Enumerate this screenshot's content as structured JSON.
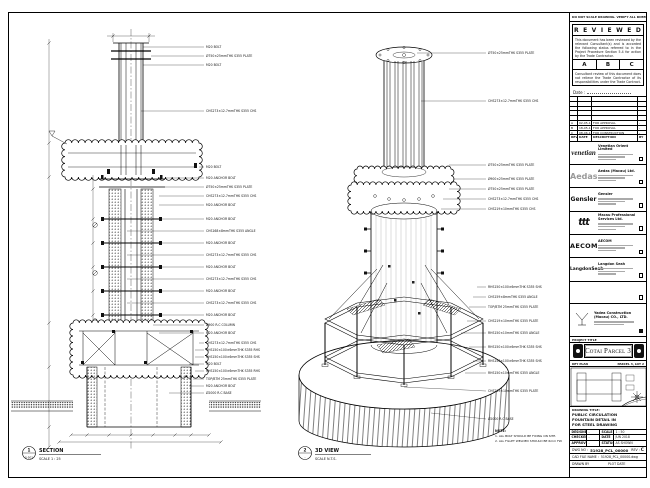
{
  "sheet": {
    "top_note": "DO NOT SCALE DRAWING. VERIFY ALL DIMENSIONS ON SITE."
  },
  "section_view": {
    "bubble_number": "1",
    "bubble_ref": "S-501",
    "title": "SECTION",
    "scale": "SCALE 1 : 25",
    "labels": [
      "M20 BOLT",
      "Ø750×25mmTHK S355 PLATE",
      "M20 BOLT",
      "CHS273×12.7mmTHK S355 CHS",
      "M20 BOLT",
      "M20 ANCHOR BOLT",
      "Ø750×25mmTHK S355 PLATE",
      "CHS273×12.7mmTHK S355 CHS",
      "M20 ANCHOR BOLT",
      "M20 ANCHOR BOLT",
      "CHS168×8mmTHK S355 ANGLE",
      "M20 ANCHOR BOLT",
      "CHS273×12.7mmTHK S355 CHS",
      "M20 ANCHOR BOLT",
      "CHS273×12.7mmTHK S355 CHS",
      "M20 ANCHOR BOLT",
      "CHS273×12.7mmTHK S355 CHS",
      "M20 ANCHOR BOLT",
      "Ø900 R.C COLUMN",
      "M20 ANCHOR BOLT",
      "CHS273×12.7mmTHK S355 CHS",
      "RHS150×100×6mmTHK S355 RHS",
      "RHS150×100×6mmTHK S355 SHS",
      "M20 BOLT",
      "RHS150×100×6mmTHK S355 RHS",
      "TOP/BTM 25mmTHK S355 PLATE",
      "M20 ANCHOR BOLT",
      "Ø2000 R.C BASE"
    ]
  },
  "iso_view": {
    "bubble_number": "2",
    "bubble_ref": "-",
    "title": "3D VIEW",
    "scale": "SCALE N.T.S.",
    "labels": [
      "Ø750×25mmTHK S355 PLATE",
      "CHS273×12.7mmTHK S355 CHS",
      "Ø750×25mmTHK S355 PLATE",
      "Ø900×25mmTHK S355 PLATE",
      "Ø750×25mmTHK S355 PLATE",
      "CHS273×12.7mmTHK S355 CHS",
      "CHS219×10mmTHK S355 CHS",
      "RHS150×100×6mmTHK S355 SHS",
      "CHS159×8mmTHK S355 ANGLE",
      "TOP/BTM 25mmTHK S355 PLATE",
      "CHS219×10mmTHK S355 PLATE",
      "RHS150×10mmTHK S355 ANGLE",
      "RHS150×100×6mmTHK S355 SHS",
      "RHS150×100×6mmTHK S355 SHS",
      "RHS150×10mmTHK S355 ANGLE",
      "CHS219×10mmTHK S355 PLATE",
      "Ø2000 R.C BASE"
    ],
    "note_heading": "NOTE:",
    "note_lines": [
      "1. ALL BOLT SHOULD BE FIXING ON SITE.",
      "2. ALL FILLET WELDED SHOULD BE 6mm FW."
    ]
  },
  "titleblock": {
    "reviewed": {
      "title": "R E V I E W E D",
      "para1": "This document has been reviewed by the relevant Consultant(s) and is accorded the following status referred to in the Project Procedure Section 5.4 for action by the Trade Contractor.",
      "options": [
        "A",
        "B",
        "C"
      ],
      "para2": "Consultant review of this document does not relieve the Trade Contractor of its responsibilities under the Trade Contract.",
      "date_label": "Date :"
    },
    "revision_table": {
      "headers": [
        "REV",
        "DATE",
        "DESCRIPTION",
        "BY"
      ],
      "rows": [
        {
          "rev": "A",
          "date": "02-05-18",
          "desc": "FOR APPROVAL",
          "by": "-"
        },
        {
          "rev": "B",
          "date": "18-05-18",
          "desc": "FOR APPROVAL",
          "by": "-"
        },
        {
          "rev": "C",
          "date": "08-06-18",
          "desc": "FOR CONSTRUCTION",
          "by": "-"
        }
      ]
    },
    "companies": [
      {
        "logo": "venetian",
        "name": "Venetian Orient Limited"
      },
      {
        "logo": "Aedas",
        "name": "Aedas (Macau) Ltd."
      },
      {
        "logo": "Gensler",
        "name": "Gensler"
      },
      {
        "logo": "ttt",
        "name": "Macau Professional Services Ltd."
      },
      {
        "logo": "AECOM",
        "name": "AECOM"
      },
      {
        "logo": "LangdonSeah",
        "name": "Langdon Seah"
      }
    ],
    "contractor": {
      "name_line1": "Yadea Construction",
      "name_line2": "(Macau) CO., LTD."
    },
    "project": {
      "label": "PROJECT TITLE",
      "name": "Cotai Parcel 3"
    },
    "key_plan": {
      "label": "KEY PLAN",
      "ref": "PARCEL 3, LOT 2"
    },
    "drawing_title": {
      "label": "DRAWING TITLE:",
      "lines": [
        "PUBLIC CIRCULATION",
        "FOUNTAIN DETAIL IN",
        "FOR STEEL DRAWING"
      ]
    },
    "info_table": {
      "rows": [
        {
          "k1": "DESIGNED",
          "v1": "-",
          "k2": "SCALE",
          "v2": "1 : 50"
        },
        {
          "k1": "CHECKED",
          "v1": "-",
          "k2": "DATE",
          "v2": "JUN 2018"
        },
        {
          "k1": "APPROVED",
          "v1": "-",
          "k2": "STATUS",
          "v2": "AS SHOWN"
        }
      ]
    },
    "dwg": {
      "label": "DWG NO :",
      "value": "51928_PCL_00000",
      "rev_label": "REV :",
      "rev": "C"
    },
    "cad": {
      "label": "CAD FILE NAME :",
      "value": "51928_PCL_00000.dwg"
    },
    "plot": {
      "left": "DRAWN BY",
      "right": "PLOT DATE"
    }
  }
}
